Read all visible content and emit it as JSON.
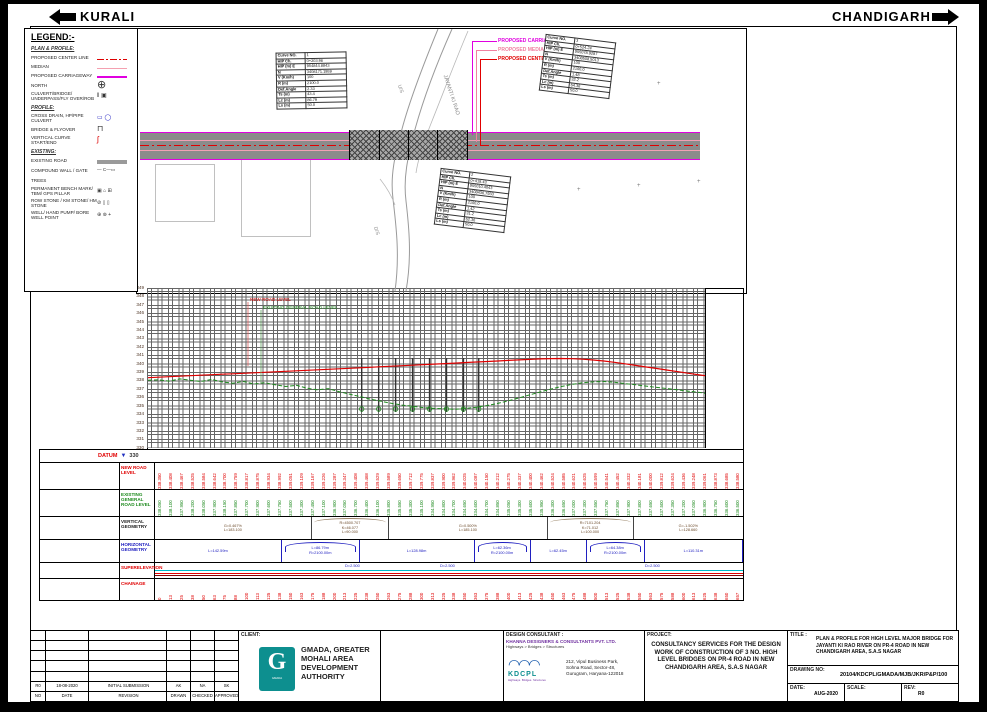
{
  "header": {
    "left_destination": "KURALI",
    "right_destination": "CHANDIGARH"
  },
  "legend": {
    "title": "LEGEND:-",
    "sections": [
      {
        "title": "PLAN & PROFILE:",
        "items": [
          {
            "label": "PROPOSED CENTER LINE",
            "sym": "centerline"
          },
          {
            "label": "MEDIAN",
            "sym": "median"
          },
          {
            "label": "PROPOSED CARRIAGEWAY",
            "sym": "carriageway"
          },
          {
            "label": "NORTH",
            "sym": "north"
          },
          {
            "label": "CULVERT/BRIDGE/ UNDERPASS/FLY OVER/ROB",
            "sym": "culvert"
          }
        ]
      },
      {
        "title": "PROFILE:",
        "items": [
          {
            "label": "CROSS DRAIN, HP/PIPE CULVERT",
            "sym": "crossdrain"
          },
          {
            "label": "BRIDGE & FLYOVER",
            "sym": "bridge"
          },
          {
            "label": "VERTICAL CURVE START/END",
            "sym": "vc"
          }
        ]
      },
      {
        "title": "EXISTING:",
        "items": [
          {
            "label": "EXISTING ROAD",
            "sym": "existing-road"
          },
          {
            "label": "COMPOUND WALL / GATE",
            "sym": "wall"
          },
          {
            "label": "TREES",
            "sym": "trees"
          },
          {
            "label": "PERMANENT BENCH MARK/ TBM/ GPS PILLAR",
            "sym": "pbm"
          },
          {
            "label": "ROW STONE / KM STONE/ HM STONE",
            "sym": "rowstone"
          },
          {
            "label": "WELL/ HAND PUMP/ BORE WELL POINT",
            "sym": "well"
          }
        ]
      }
    ]
  },
  "plan": {
    "callouts": {
      "carriageway": "PROPOSED CARRIAGEWAY",
      "median": "PROPOSED MEDIAN",
      "centerline": "PROPOSED CENTERLINE"
    },
    "stream_label": "JAYANTI KI RAO",
    "upstream": "U/S",
    "downstream": "D/S",
    "chainages": [
      {
        "label": "0+000",
        "m": 0
      },
      {
        "label": "0+050",
        "m": 50
      },
      {
        "label": "0+100",
        "m": 100
      },
      {
        "label": "0+150",
        "m": 150
      },
      {
        "label": "0+200",
        "m": 200
      },
      {
        "label": "0+250",
        "m": 250
      },
      {
        "label": "0+300",
        "m": 300
      },
      {
        "label": "0+350",
        "m": 350
      },
      {
        "label": "0+400",
        "m": 400
      },
      {
        "label": "0+450",
        "m": 450
      },
      {
        "label": "0+500",
        "m": 500
      },
      {
        "label": "0+550",
        "m": 550
      },
      {
        "label": "0+600",
        "m": 600
      },
      {
        "label": "0+650",
        "m": 650
      },
      {
        "label": "0+657",
        "m": 657
      }
    ],
    "curve_tables": [
      {
        "rows": [
          {
            "k": "Curve NO.",
            "v": "1"
          },
          {
            "k": "HIP Ch.",
            "v": "0+203.96"
          },
          {
            "k": "HIP (m) E",
            "v": "954844.8843"
          },
          {
            "k": "N",
            "v": "3408171.1959"
          },
          {
            "k": "V (Km/h)",
            "v": "100"
          },
          {
            "k": "R (m)",
            "v": "2100.0"
          },
          {
            "k": "Def.Angle",
            "v": "2.33"
          },
          {
            "k": "Ts (m)",
            "v": "43.4"
          },
          {
            "k": "Lc (m)",
            "v": "86.79"
          },
          {
            "k": "Ls (m)",
            "v": "50.0"
          }
        ]
      },
      {
        "rows": [
          {
            "k": "Curve NO.",
            "v": "2"
          },
          {
            "k": "HIP Ch.",
            "v": "0+418.43"
          },
          {
            "k": "HIP (m) E",
            "v": "955010.4043"
          },
          {
            "k": "N",
            "v": "3408436.7933"
          },
          {
            "k": "V (Km/h)",
            "v": "100"
          },
          {
            "k": "R (m)",
            "v": "2100.0"
          },
          {
            "k": "Def.Angle",
            "v": "1.42"
          },
          {
            "k": "Ts (m)",
            "v": "31.2"
          },
          {
            "k": "Lc (m)",
            "v": "62.36"
          },
          {
            "k": "Ls (m)",
            "v": "50.0"
          }
        ]
      },
      {
        "rows": [
          {
            "k": "Curve NO.",
            "v": "3"
          },
          {
            "k": "HIP Ch.",
            "v": "0+524.24"
          },
          {
            "k": "HIP (m) E",
            "v": "955078.9287"
          },
          {
            "k": "N",
            "v": "3408508.5013"
          },
          {
            "k": "V (Km/h)",
            "v": "100"
          },
          {
            "k": "R (m)",
            "v": "2100.0"
          },
          {
            "k": "Def.Angle",
            "v": "1.48"
          },
          {
            "k": "Ts (m)",
            "v": "32.2"
          },
          {
            "k": "Lc (m)",
            "v": "64.38"
          },
          {
            "k": "Ls (m)",
            "v": "50.0"
          }
        ]
      }
    ]
  },
  "profile": {
    "elevations": [
      "349",
      "348",
      "347",
      "346",
      "345",
      "344",
      "343",
      "342",
      "341",
      "340",
      "339",
      "338",
      "337",
      "336",
      "335",
      "334",
      "333",
      "332",
      "331",
      "330"
    ],
    "new_road_label": "NEW ROAD LEVEL",
    "existing_label": "EXISTING GENERAL ROAD LEVEL",
    "piers": [
      252,
      272,
      292,
      312,
      332,
      352,
      372,
      390
    ]
  },
  "bands": {
    "datum": {
      "label": "DATUM",
      "value": "330"
    },
    "row_labels": {
      "new_road": "NEW ROAD LEVEL",
      "existing": "EXISTING GENERAL ROAD LEVEL",
      "vertical": "VERTICAL GEOMETRY",
      "horizontal": "HORIZONTAL GEOMETRY",
      "superelevation": "SUPERELEVATION",
      "chainage": "CHAINAGE"
    },
    "stations": [
      0,
      12.5,
      25,
      37.5,
      50,
      62.5,
      75,
      87.5,
      100,
      112.5,
      125,
      137.5,
      150,
      162.5,
      175,
      187.5,
      200,
      212.5,
      225,
      237.5,
      250,
      262.5,
      275,
      287.5,
      300,
      312.5,
      325,
      337.5,
      350,
      362.5,
      375,
      387.5,
      400,
      412.5,
      425,
      437.5,
      450,
      462.5,
      475,
      487.5,
      500,
      512.5,
      525,
      537.5,
      550,
      562.5,
      575,
      587.5,
      600,
      612.5,
      625,
      637.5,
      650,
      657
    ],
    "new_road_levels": [
      "338.350",
      "338.408",
      "338.467",
      "338.525",
      "338.584",
      "338.642",
      "338.700",
      "338.759",
      "338.817",
      "338.875",
      "338.934",
      "338.992",
      "339.051",
      "339.109",
      "339.167",
      "339.226",
      "339.287",
      "339.347",
      "339.408",
      "339.468",
      "339.529",
      "339.589",
      "339.650",
      "339.712",
      "339.775",
      "339.837",
      "339.900",
      "339.962",
      "340.025",
      "340.087",
      "340.150",
      "340.212",
      "340.275",
      "340.337",
      "340.400",
      "340.462",
      "340.524",
      "340.585",
      "340.621",
      "340.625",
      "340.599",
      "340.541",
      "340.452",
      "340.332",
      "340.181",
      "340.000",
      "339.812",
      "339.624",
      "339.436",
      "339.248",
      "339.061",
      "338.873",
      "338.685",
      "338.580"
    ],
    "existing_levels": [
      "338.050",
      "338.100",
      "337.950",
      "338.200",
      "338.050",
      "337.900",
      "338.150",
      "337.850",
      "337.700",
      "337.900",
      "337.600",
      "337.750",
      "337.500",
      "337.300",
      "337.450",
      "337.100",
      "336.900",
      "337.050",
      "336.700",
      "336.400",
      "336.100",
      "335.800",
      "335.550",
      "335.300",
      "335.100",
      "334.950",
      "334.800",
      "334.700",
      "334.650",
      "334.600",
      "334.700",
      "334.850",
      "335.050",
      "335.300",
      "335.600",
      "335.950",
      "336.300",
      "336.650",
      "337.000",
      "337.300",
      "337.550",
      "337.750",
      "337.850",
      "337.900",
      "337.800",
      "337.650",
      "337.500",
      "337.350",
      "337.200",
      "337.050",
      "336.900",
      "336.750",
      "336.600",
      "336.500"
    ],
    "chainage_values": [
      "0",
      "13",
      "25",
      "38",
      "50",
      "63",
      "75",
      "88",
      "100",
      "113",
      "125",
      "138",
      "150",
      "163",
      "175",
      "188",
      "200",
      "213",
      "225",
      "238",
      "250",
      "263",
      "275",
      "288",
      "300",
      "313",
      "325",
      "338",
      "350",
      "363",
      "375",
      "388",
      "400",
      "413",
      "425",
      "438",
      "450",
      "463",
      "475",
      "488",
      "500",
      "513",
      "525",
      "538",
      "550",
      "563",
      "575",
      "588",
      "600",
      "613",
      "625",
      "638",
      "650",
      "657"
    ],
    "vertical_geometry": [
      {
        "kind": "grade",
        "dir": "up",
        "l1": "G=0.467%",
        "l2": "L=183.100",
        "w": 183.1
      },
      {
        "kind": "crest",
        "l1": "R=4500.707",
        "l2": "K=46.077",
        "l3": "L=90.000",
        "w": 90
      },
      {
        "kind": "grade",
        "dir": "up",
        "l1": "G=0.500%",
        "l2": "L=185.100",
        "w": 185.1
      },
      {
        "kind": "crest",
        "l1": "R=7101.204",
        "l2": "K=71.012",
        "l3": "L=100.000",
        "w": 100
      },
      {
        "kind": "grade",
        "dir": "down",
        "l1": "G=-1.502%",
        "l2": "L=128.660",
        "w": 128.66
      }
    ],
    "horizontal_geometry": [
      {
        "kind": "tangent",
        "l1": "L=142.59m",
        "w": 142.59
      },
      {
        "kind": "curve",
        "l1": "L=86.79m",
        "l2": "R=2100.00m",
        "w": 86.79
      },
      {
        "kind": "tangent",
        "l1": "L=128.98m",
        "w": 128.98
      },
      {
        "kind": "curve",
        "l1": "L=62.36m",
        "l2": "R=2100.00m",
        "w": 62.36
      },
      {
        "kind": "tangent",
        "l1": "L=62.45m",
        "w": 62.45
      },
      {
        "kind": "curve",
        "l1": "L=64.38m",
        "l2": "R=2100.00m",
        "w": 64.38
      },
      {
        "kind": "tangent",
        "l1": "L=110.31m",
        "w": 110.31
      }
    ],
    "superelevation_labels": [
      "D=2.500",
      "D=2.500",
      "D=2.500"
    ]
  },
  "title_block": {
    "revision_table": {
      "filled_row": {
        "no": "R0",
        "date": "18-08-2020",
        "revision": "INITIAL SUBMISSION",
        "drawn": "AK",
        "checked": "NA",
        "approved": "SK"
      },
      "header_row": {
        "no": "NO",
        "date": "DATE",
        "revision": "REVISION",
        "drawn": "DRAWN",
        "checked": "CHECKED",
        "approved": "APPROVED"
      }
    },
    "client": {
      "head": "CLIENT:",
      "name": "GMADA, GREATER MOHALI AREA DEVELOPMENT AUTHORITY",
      "logo_letter": "G",
      "logo_sub": "GMADA"
    },
    "design_consultant": {
      "head": "DESIGN CONSULTANT :",
      "firm": "KHANNA DESIGNERS & CONSULTANTS PVT. LTD.",
      "tagline": "Highways > Bridges > Structures",
      "logo_text": "KDCPL",
      "logo_tag": "Highways· Bridges· Structures",
      "address_1": "212,  Vipul Business Park,",
      "address_2": "Sohna Road, Sector-48,",
      "address_3": "Gurugram, Haryana-122018"
    },
    "project": {
      "head": "PROJECT:",
      "text": "CONSULTANCY SERVICES FOR THE DESIGN WORK OF CONSTRUCTION OF 3 NO. HIGH LEVEL BRIDGES ON PR-4 ROAD IN NEW CHANDIGARH AREA, S.A.S NAGAR"
    },
    "title": {
      "head": "TITLE :",
      "text": "PLAN & PROFILE  FOR HIGH LEVEL MAJOR BRIDGE FOR JAYANTI KI RAO RIVER ON PR-4 ROAD IN NEW CHANDIGARH AREA, S.A.S NAGAR"
    },
    "drawing_no": {
      "head": "DRAWING NO:",
      "value": "20104/KDCPL/GMADA/MJB/JKR/P&P/100"
    },
    "date": {
      "head": "DATE:",
      "value": "AUG-2020"
    },
    "scale": {
      "head": "SCALE:",
      "value": ""
    },
    "rev": {
      "head": "REV:",
      "value": "R0"
    }
  },
  "colors": {
    "centerline_red": "#e00000",
    "median_pink": "#f0a0b4",
    "carriageway_magenta": "#e000e0",
    "existing_green": "#1e8a1e",
    "geometry_blue": "#2020c0",
    "superelevation_cyan": "#00b8c8",
    "gmada_teal": "#0d8f8f",
    "khanna_purple": "#7030a0",
    "kdcpl_blue": "#1f5fae"
  }
}
